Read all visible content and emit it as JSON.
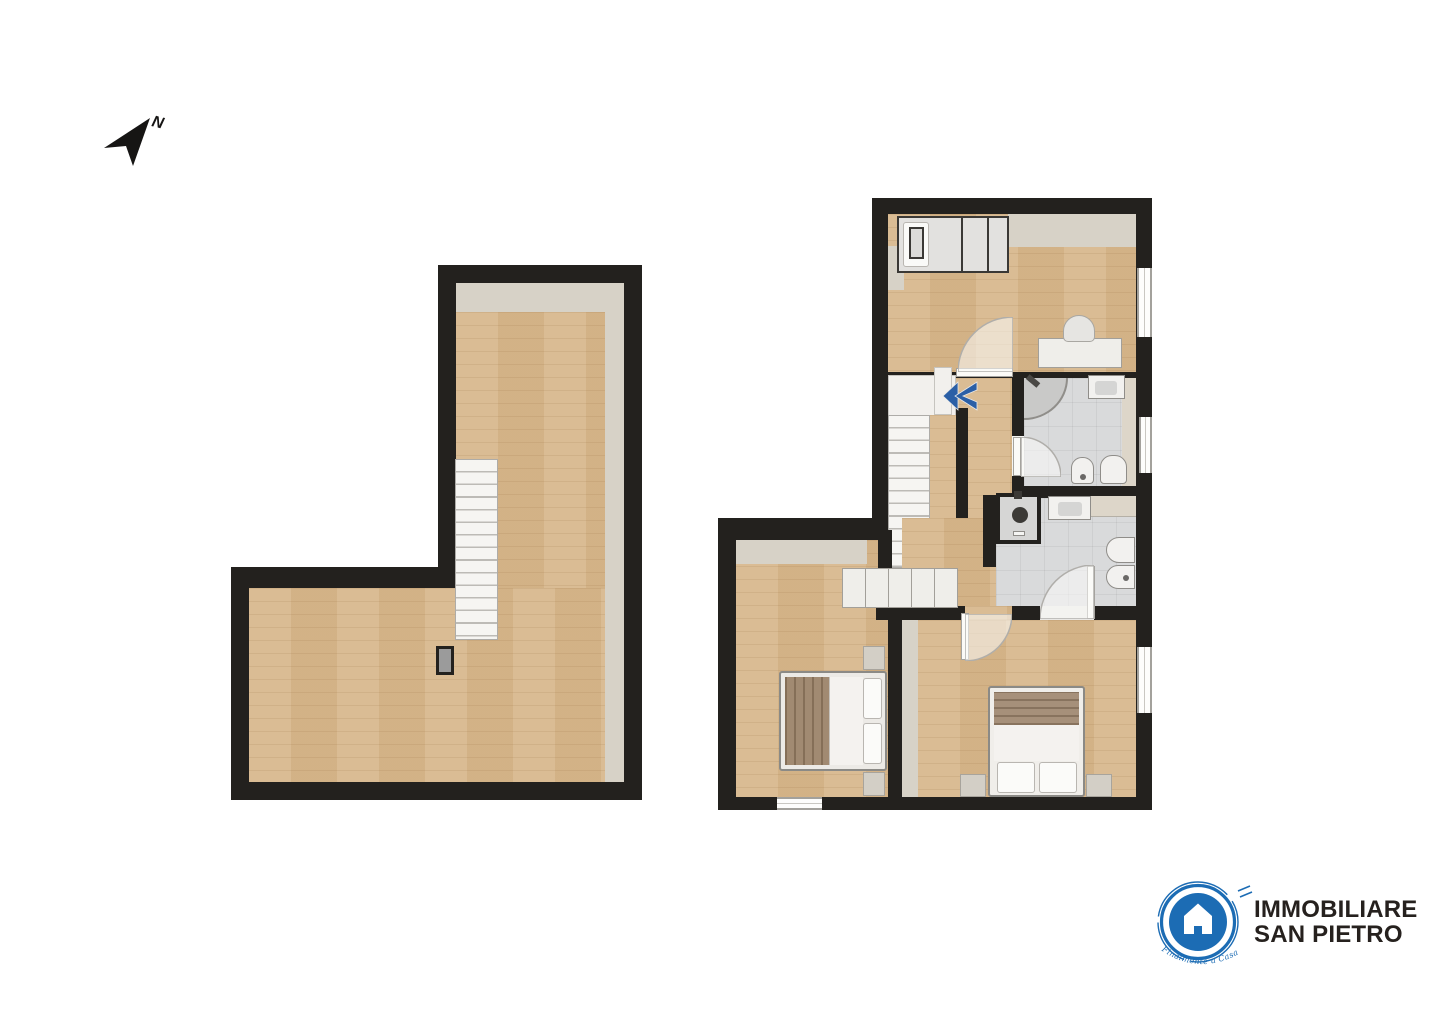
{
  "compass": {
    "label": "N",
    "icon": "north-arrow-icon"
  },
  "stairs_indicator": {
    "icon": "double-chevron-left-icon",
    "color": "#2b5fa6"
  },
  "logo": {
    "line1": "IMMOBILIARE",
    "line2": "SAN PIETRO",
    "tagline": "Finalmente a Casa",
    "icon": "house-icon",
    "brand_blue": "#1c6cb4",
    "text_color": "#26211e"
  },
  "palette": {
    "wall": "#23211e",
    "wood_floor": "#d8b88d",
    "trim_beige": "#d7d2c7",
    "bath_tile": "#d9dadb",
    "stair_white": "#f6f5f2",
    "accent_blue": "#2b5fa6"
  }
}
